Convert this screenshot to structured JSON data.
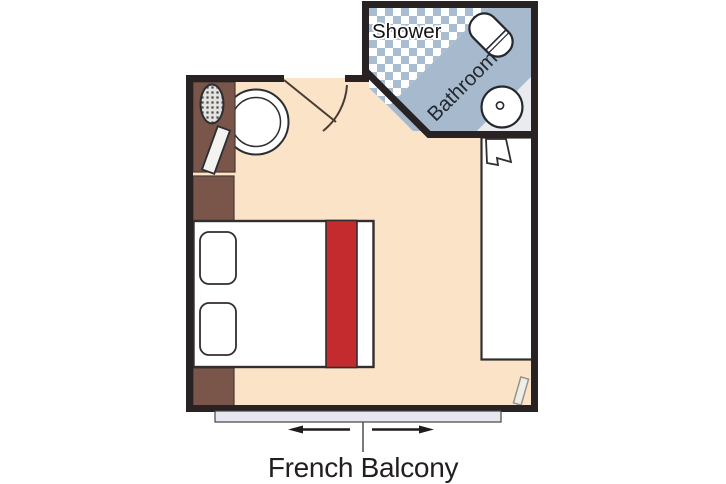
{
  "plan": {
    "name": "stateroom-floor-plan",
    "labels": {
      "shower": "Shower",
      "bathroom": "Bathroom",
      "french_balcony": "French Balcony"
    },
    "colors": {
      "wall": "#282223",
      "floor": "#fbe3c7",
      "furniture_brown": "#7a5549",
      "bed_runner_red": "#c32b2e",
      "bathroom_band_blue": "#a6b9cd",
      "shower_check_blue": "#a9bdd2",
      "bathroom_floor_gray": "#e9ebee",
      "balcony_strip_gray": "#e7e8ef",
      "outline_dark": "#332d2e"
    }
  }
}
